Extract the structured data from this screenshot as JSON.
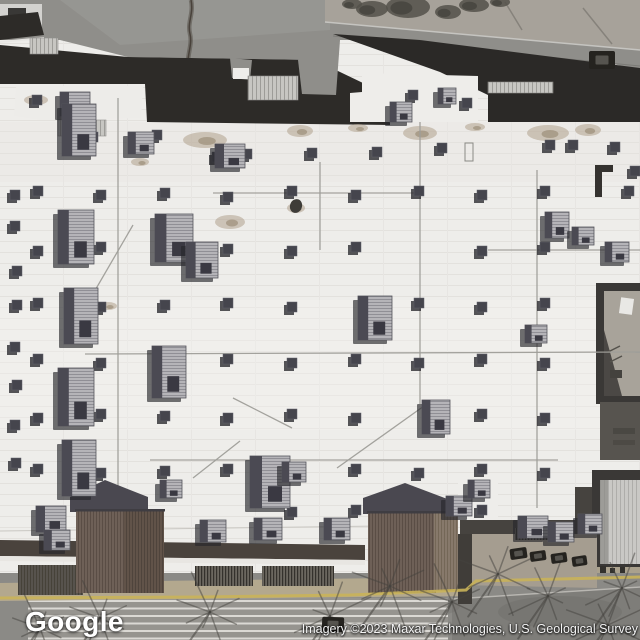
{
  "map": {
    "provider": "Google",
    "view": "satellite",
    "attribution": "Imagery ©2023 Maxar Technologies, U.S. Geological Survey"
  },
  "colors": {
    "asphalt": "#8f8e8a",
    "asphaltLight": "#9e9d99",
    "gravel": "#a7a29a",
    "roofWhite": "#eeedea",
    "seam": "#e1dfdb",
    "roofDark": "#2d2b28",
    "midGray": "#57544f",
    "vent": "#45454d",
    "ventShadow": "#2c2c31",
    "hvacTop": "#b5b4b8",
    "hvacSide": "#4b4a53",
    "shadow": "#26262b",
    "skylight": "#c7c6c2",
    "courtyard": "#a8a39a",
    "gableDark": "#4a4850",
    "gableBrown": "#6e6057",
    "canopy": "#4a433d",
    "walkway": "#55514b",
    "sidewalk": "#b3a88e",
    "curbYellow": "#c9b259",
    "parking": "#8b8a86",
    "road": "#7e7d79",
    "stripe": "#dbd9d4",
    "branch": "#45433f",
    "car": "#25231f"
  },
  "scene": {
    "skylights": [
      [
        30,
        38,
        28,
        16
      ],
      [
        58,
        120,
        48,
        16
      ],
      [
        248,
        76,
        50,
        24
      ],
      [
        488,
        82,
        65,
        11
      ]
    ],
    "vents": [
      [
        32,
        95
      ],
      [
        78,
        100
      ],
      [
        212,
        152
      ],
      [
        242,
        149
      ],
      [
        88,
        132
      ],
      [
        152,
        130
      ],
      [
        372,
        147
      ],
      [
        437,
        143
      ],
      [
        408,
        90
      ],
      [
        462,
        98
      ],
      [
        545,
        140
      ],
      [
        610,
        142
      ],
      [
        630,
        166
      ],
      [
        568,
        140
      ],
      [
        10,
        190
      ],
      [
        10,
        221
      ],
      [
        12,
        266
      ],
      [
        12,
        300
      ],
      [
        10,
        342
      ],
      [
        12,
        380
      ],
      [
        10,
        420
      ],
      [
        11,
        458
      ],
      [
        33,
        186
      ],
      [
        96,
        190
      ],
      [
        160,
        188
      ],
      [
        223,
        192
      ],
      [
        287,
        186
      ],
      [
        351,
        190
      ],
      [
        414,
        186
      ],
      [
        477,
        190
      ],
      [
        540,
        186
      ],
      [
        624,
        186
      ],
      [
        33,
        246
      ],
      [
        96,
        242
      ],
      [
        223,
        244
      ],
      [
        287,
        246
      ],
      [
        351,
        242
      ],
      [
        477,
        246
      ],
      [
        540,
        242
      ],
      [
        33,
        298
      ],
      [
        96,
        302
      ],
      [
        160,
        300
      ],
      [
        223,
        298
      ],
      [
        287,
        302
      ],
      [
        414,
        298
      ],
      [
        477,
        302
      ],
      [
        540,
        298
      ],
      [
        33,
        354
      ],
      [
        96,
        358
      ],
      [
        160,
        356
      ],
      [
        223,
        354
      ],
      [
        287,
        358
      ],
      [
        351,
        354
      ],
      [
        414,
        358
      ],
      [
        477,
        354
      ],
      [
        540,
        358
      ],
      [
        33,
        413
      ],
      [
        96,
        409
      ],
      [
        160,
        411
      ],
      [
        223,
        413
      ],
      [
        287,
        409
      ],
      [
        351,
        413
      ],
      [
        477,
        409
      ],
      [
        540,
        413
      ],
      [
        33,
        464
      ],
      [
        96,
        468
      ],
      [
        160,
        466
      ],
      [
        223,
        464
      ],
      [
        351,
        464
      ],
      [
        414,
        468
      ],
      [
        477,
        464
      ],
      [
        540,
        468
      ],
      [
        287,
        507
      ],
      [
        351,
        505
      ],
      [
        477,
        505
      ],
      [
        307,
        148
      ]
    ],
    "hvac": [
      [
        60,
        92,
        30,
        24
      ],
      [
        62,
        104,
        34,
        52
      ],
      [
        58,
        210,
        36,
        54
      ],
      [
        64,
        288,
        34,
        56
      ],
      [
        58,
        368,
        36,
        58
      ],
      [
        62,
        440,
        34,
        56
      ],
      [
        36,
        506,
        30,
        26
      ],
      [
        44,
        530,
        26,
        20
      ],
      [
        155,
        214,
        38,
        48
      ],
      [
        186,
        242,
        32,
        36
      ],
      [
        152,
        346,
        34,
        52
      ],
      [
        250,
        456,
        40,
        52
      ],
      [
        358,
        296,
        34,
        44
      ],
      [
        422,
        400,
        28,
        34
      ],
      [
        545,
        212,
        24,
        26
      ],
      [
        572,
        227,
        22,
        18
      ],
      [
        605,
        242,
        24,
        20
      ],
      [
        128,
        132,
        26,
        22
      ],
      [
        215,
        144,
        30,
        24
      ],
      [
        390,
        102,
        22,
        20
      ],
      [
        438,
        88,
        18,
        16
      ],
      [
        200,
        520,
        26,
        22
      ],
      [
        254,
        518,
        28,
        22
      ],
      [
        324,
        518,
        26,
        22
      ],
      [
        446,
        496,
        26,
        20
      ],
      [
        468,
        480,
        22,
        18
      ],
      [
        518,
        516,
        30,
        22
      ],
      [
        548,
        522,
        26,
        20
      ],
      [
        578,
        514,
        24,
        20
      ],
      [
        160,
        480,
        22,
        18
      ],
      [
        282,
        462,
        24,
        20
      ],
      [
        525,
        325,
        22,
        18
      ]
    ],
    "conduits": [
      [
        420,
        122,
        420,
        404
      ],
      [
        537,
        170,
        537,
        508
      ],
      [
        213,
        193,
        418,
        193
      ],
      [
        85,
        354,
        640,
        352
      ],
      [
        150,
        460,
        558,
        460
      ],
      [
        118,
        98,
        118,
        542
      ],
      [
        133,
        225,
        79,
        318
      ],
      [
        337,
        468,
        424,
        406
      ],
      [
        233,
        398,
        292,
        428
      ],
      [
        193,
        478,
        240,
        441
      ],
      [
        320,
        162,
        320,
        250
      ],
      [
        488,
        250,
        640,
        250
      ]
    ],
    "stains": [
      [
        205,
        140,
        22,
        8
      ],
      [
        300,
        131,
        13,
        6
      ],
      [
        420,
        133,
        17,
        7
      ],
      [
        548,
        133,
        21,
        8
      ],
      [
        588,
        130,
        13,
        6
      ],
      [
        230,
        222,
        15,
        7
      ],
      [
        296,
        208,
        9,
        5
      ],
      [
        108,
        306,
        9,
        4
      ],
      [
        358,
        128,
        10,
        4
      ],
      [
        36,
        100,
        12,
        5
      ],
      [
        140,
        162,
        9,
        4
      ],
      [
        475,
        127,
        10,
        4
      ]
    ],
    "branches": [
      [
        100,
        618
      ],
      [
        210,
        612
      ],
      [
        330,
        616
      ],
      [
        452,
        602
      ],
      [
        548,
        596
      ],
      [
        622,
        588
      ],
      [
        390,
        586
      ],
      [
        498,
        574
      ],
      [
        608,
        625
      ],
      [
        40,
        628
      ]
    ],
    "cars": [
      [
        589,
        51,
        26,
        18,
        0
      ],
      [
        510,
        548,
        17,
        11,
        -8
      ],
      [
        530,
        551,
        16,
        10,
        -8
      ],
      [
        551,
        553,
        16,
        10,
        -8
      ],
      [
        572,
        556,
        15,
        10,
        -8
      ],
      [
        322,
        617,
        22,
        15,
        2
      ]
    ],
    "shrubs": [
      [
        372,
        9,
        16,
        8
      ],
      [
        408,
        7,
        22,
        11
      ],
      [
        448,
        12,
        13,
        7
      ],
      [
        474,
        5,
        15,
        7
      ],
      [
        500,
        2,
        10,
        5
      ],
      [
        352,
        4,
        10,
        5
      ]
    ]
  }
}
